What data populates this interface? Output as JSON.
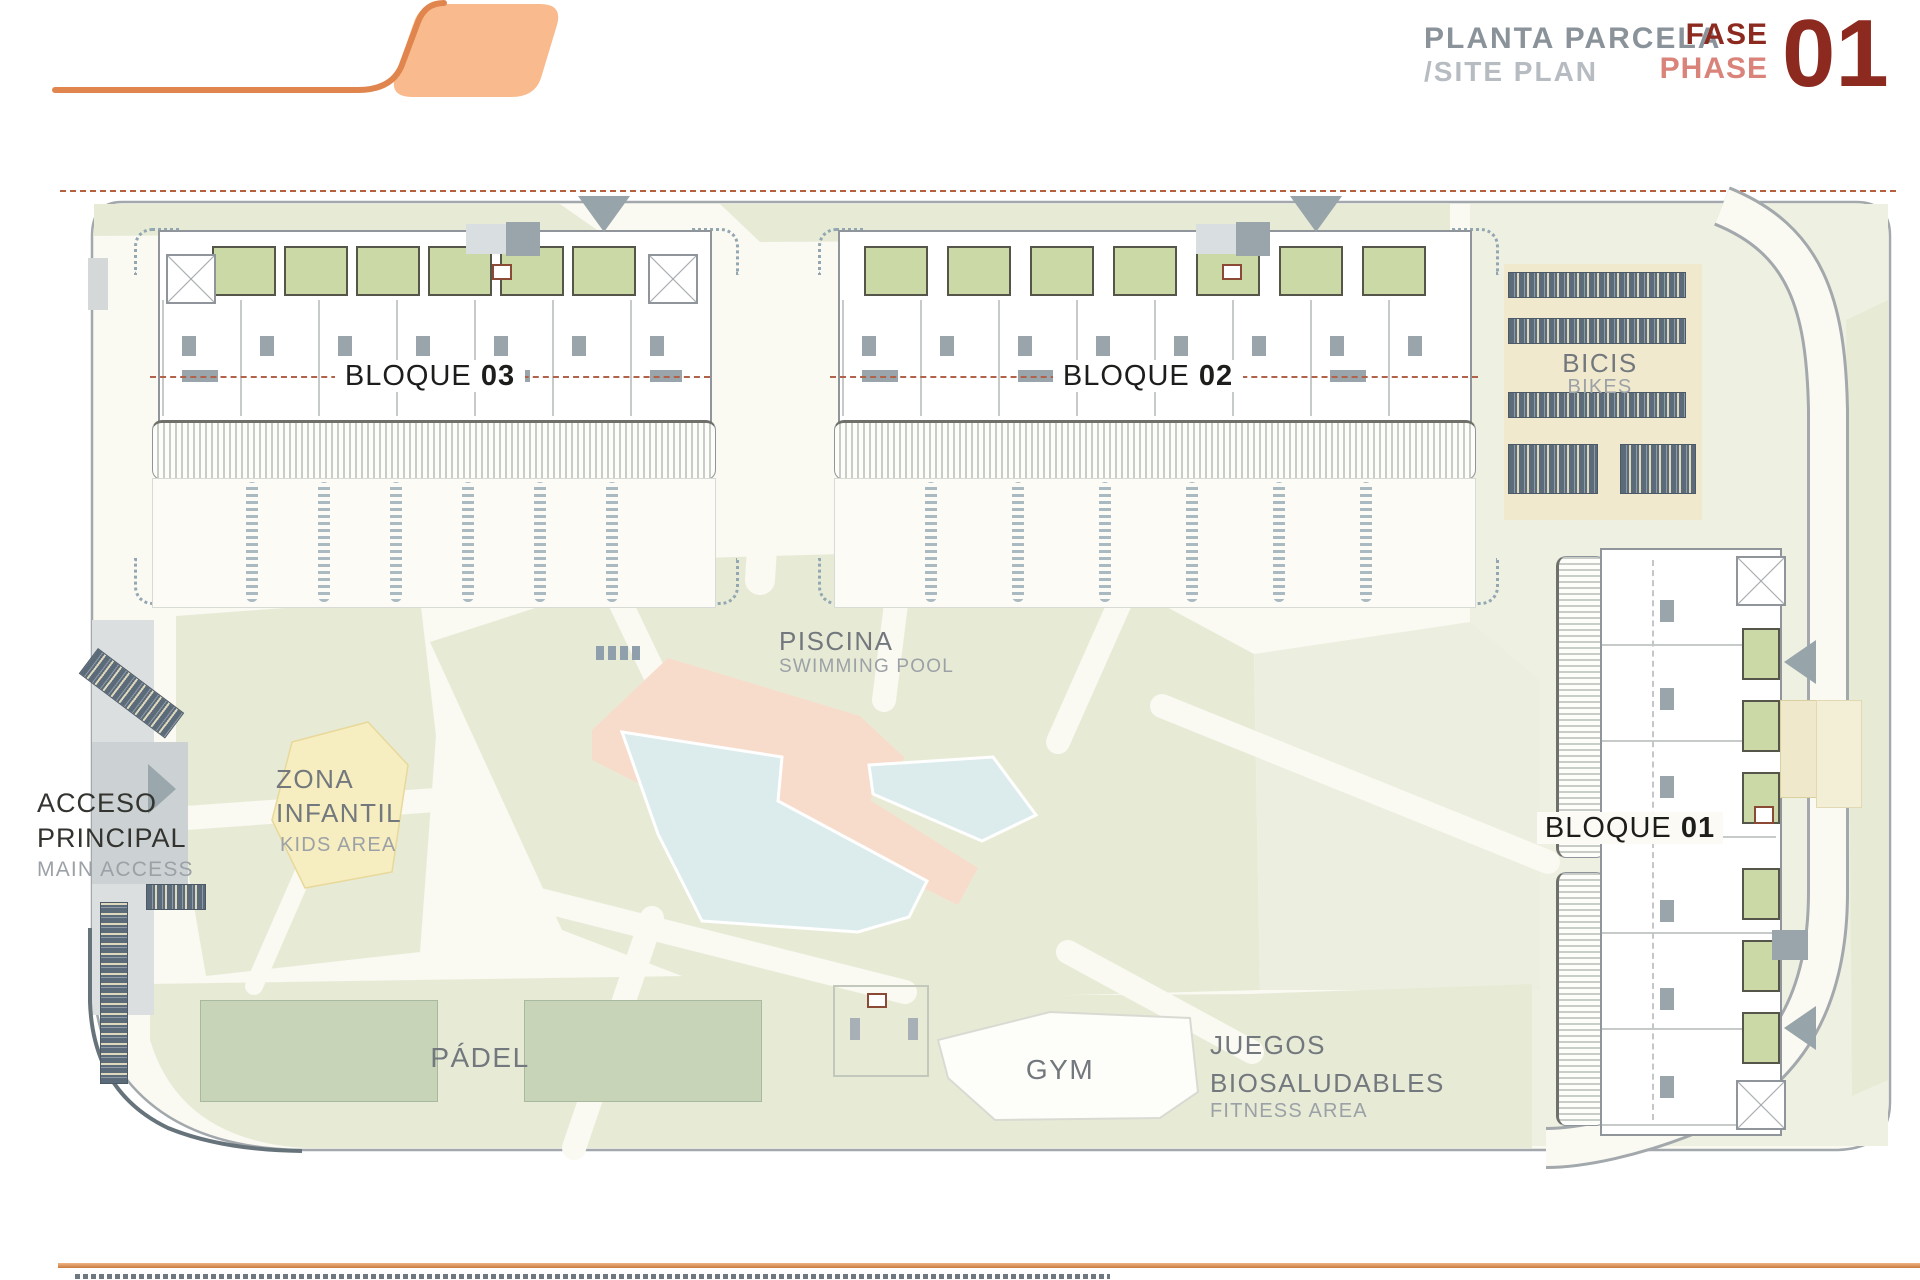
{
  "header": {
    "title_primary": "PLANTA PARCELA",
    "title_secondary": "/SITE PLAN",
    "phase": {
      "es": "FASE",
      "en": "PHASE",
      "number": "01"
    }
  },
  "plan": {
    "blocks": [
      {
        "word": "BLOQUE",
        "number": "03"
      },
      {
        "word": "BLOQUE",
        "number": "02"
      },
      {
        "word": "BLOQUE",
        "number": "01"
      }
    ],
    "areas": {
      "bikes": {
        "es": "BICIS",
        "en": "BIKES"
      },
      "pool": {
        "es": "PISCINA",
        "en": "SWIMMING POOL"
      },
      "kids": {
        "es_line1": "ZONA",
        "es_line2": "INFANTIL",
        "en": "KIDS AREA"
      },
      "access": {
        "es_line1": "ACCESO",
        "es_line2": "PRINCIPAL",
        "en": "MAIN ACCESS"
      },
      "padel": {
        "es": "PÁDEL"
      },
      "gym": {
        "label": "GYM"
      },
      "fitness": {
        "es_line1": "JUEGOS",
        "es_line2": "BIOSALUDABLES",
        "en": "FITNESS AREA"
      }
    },
    "colors": {
      "accent_orange": "#d98a4f",
      "phase_dark_red": "#8c2a20",
      "phase_salmon": "#d9837a",
      "landscape_green": "#e7ebd6",
      "pool_water": "#dcebec",
      "pool_deck": "#f8dccb",
      "boundary_dash": "#b5613f"
    }
  }
}
